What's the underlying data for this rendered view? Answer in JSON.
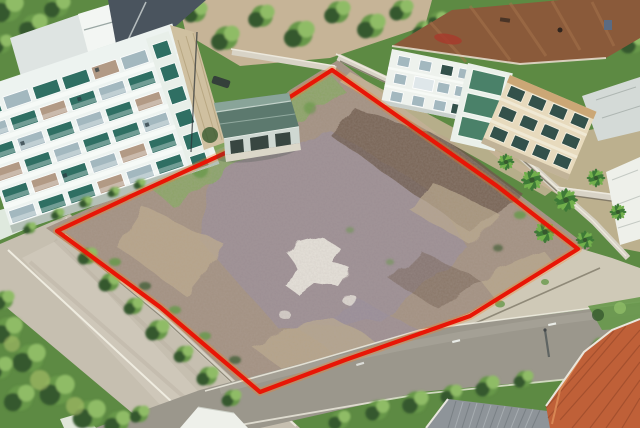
{
  "meta": {
    "width_px": 640,
    "height_px": 428,
    "type": "aerial-drone-photograph",
    "subject": "vacant dirt land plot outlined with a red boundary, between an apartment building, a brown-roof building with palms, and two roads"
  },
  "boundary": {
    "points": "332,70 290,97 234,149 140,192 57,231 160,307 260,392 345,360 470,316 578,249 497,186",
    "stroke_width": 4.2,
    "color": "#e81606",
    "glow_color": "#ff7a1f"
  },
  "plot": {
    "points": "338,60 290,90 232,143 138,186 46,228 158,308 258,402 350,366 472,322 590,248 500,180"
  },
  "colors": {
    "boundary_red": "#e81606",
    "boundary_glow": "#ff7a1f",
    "veg_base": "#5d8a43",
    "veg_dark": "#36592e",
    "veg_mid": "#67984a",
    "veg_light": "#8fbc66",
    "veg_yellow": "#aec36b",
    "road_left": "#c6bfb0",
    "road_bottom": "#9b978c",
    "road_line": "#efece0",
    "sidewalk": "#cfc9b7",
    "wall_light": "#d8d3c6",
    "wall_shadow": "#746d5d",
    "dirt": "#a39181",
    "dirt_mauve": "#988c9f",
    "dirt_tan": "#bba98c",
    "dirt_dark": "#6d594b",
    "dirt_pale": "#ebe7de",
    "plot_grass": "#87a763",
    "apt_wall": "#edf3f0",
    "apt_window_teal": "#2f6f63",
    "apt_window_gray": "#a3b8bf",
    "apt_window_tan": "#b29a85",
    "apt_roof_dark": "#4a545e",
    "apt_roof_light": "#dee4e2",
    "apt_end_wall": "#cfc0a0",
    "shack_roof": "#5c796e",
    "shack_dark": "#2b3a34",
    "shack_post": "#cfd8d2",
    "rb_roof": "#8a5a3a",
    "rb_roof_streak": "#a5744c",
    "rb_wall_white": "#eef2ed",
    "rb_wall_cream": "#e7dabd",
    "rb_glass": "#4a8169",
    "rb_window_dark": "#33514b",
    "veranda": "#d4dad7",
    "palm_dark": "#3e7a37",
    "palm_light": "#72b04c",
    "sand": "#c6b497",
    "tile_orange": "#bf6038",
    "tile_line": "#96482a",
    "metal_roof": "#8e9499",
    "metal_line": "#70777c",
    "white_roof": "#eef0ea",
    "pole": "#5f6462"
  },
  "scene": {
    "elements": [
      "vacant-plot",
      "red-boundary",
      "apartment-building",
      "shed",
      "brown-roof-building",
      "palm-trees",
      "left-road",
      "bottom-road",
      "sidewalk",
      "boundary-walls",
      "orange-tile-roof",
      "metal-roof",
      "trees",
      "bushes"
    ]
  }
}
